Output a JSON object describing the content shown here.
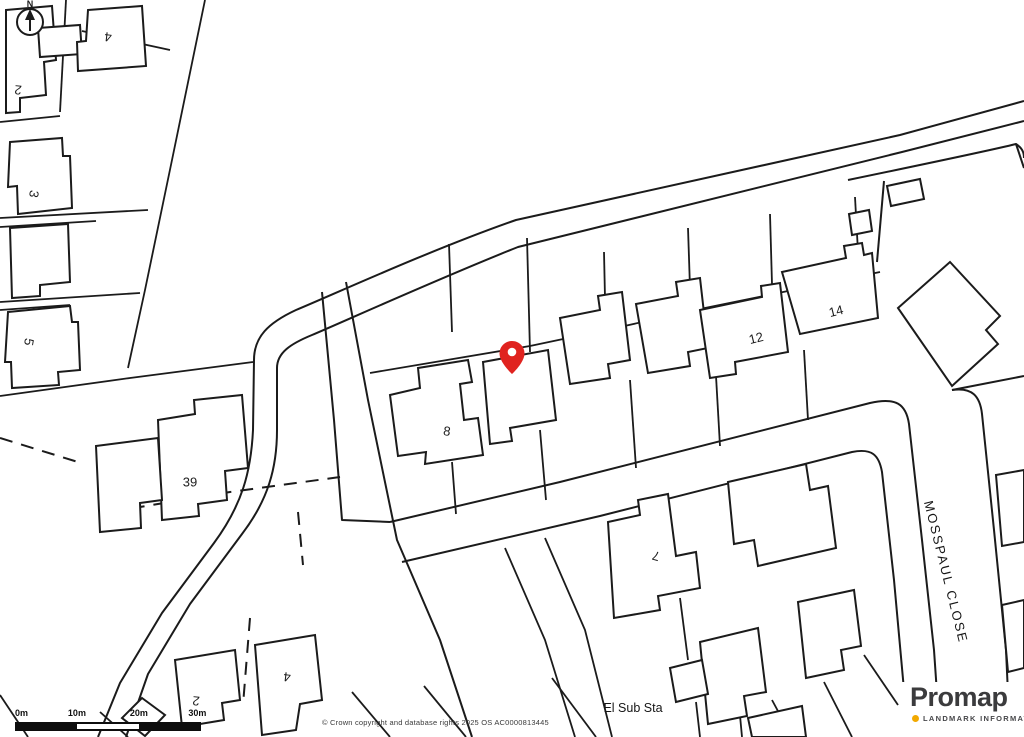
{
  "map": {
    "background": "#ffffff",
    "line_color": "#1b1b1b",
    "pin_color": "#e0231f",
    "compass_label": "N",
    "street_label": "MOSSPAUL CLOSE",
    "substation_label": "El Sub Sta",
    "plot_labels": [
      {
        "text": "2"
      },
      {
        "text": "4"
      },
      {
        "text": "3"
      },
      {
        "text": "5"
      },
      {
        "text": "39"
      },
      {
        "text": "8"
      },
      {
        "text": "12"
      },
      {
        "text": "14"
      },
      {
        "text": "7"
      },
      {
        "text": "2"
      },
      {
        "text": "4"
      }
    ]
  },
  "scale_bar": {
    "ticks": [
      "0m",
      "10m",
      "20m",
      "30m"
    ]
  },
  "attribution": "© Crown copyright and database rights 2025 OS AC0000813445",
  "logo": {
    "brand": "Promap",
    "tagline": "LANDMARK INFORMATION",
    "dot_color": "#f2a900",
    "text_color": "#3b3b3d"
  }
}
